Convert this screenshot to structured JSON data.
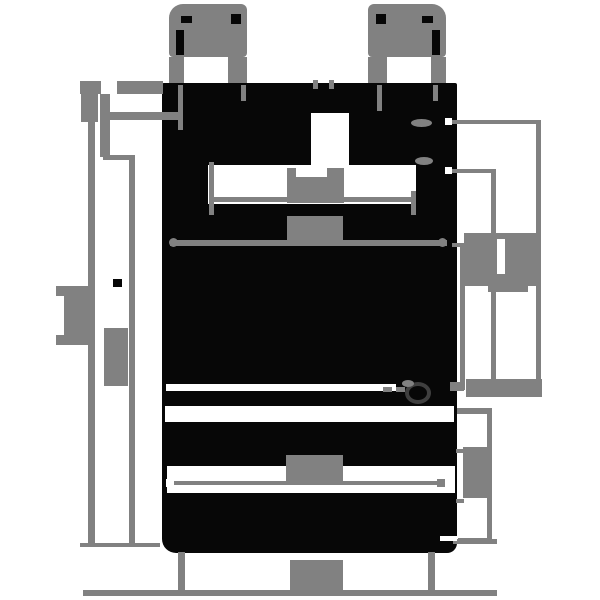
{
  "meta": {
    "kind": "technical-dimension-drawing",
    "canvas": {
      "width": 600,
      "height": 600
    },
    "background": "#ffffff",
    "text_legible": false
  },
  "colors": {
    "ink": "#070707",
    "annotation_gray": "#818181",
    "paper": "#ffffff",
    "hole_ring": "#3f3f3f"
  },
  "drawing": {
    "shapes": [
      {
        "name": "device-body",
        "kind": "ink",
        "x": 162,
        "y": 83,
        "w": 295,
        "h": 470,
        "r": "2px 2px 10px 14px",
        "z": 10
      },
      {
        "name": "cutout-top-center-notch",
        "kind": "paper",
        "x": 311,
        "y": 113,
        "w": 38,
        "h": 55,
        "z": 20
      },
      {
        "name": "cutout-top-recess",
        "kind": "paper",
        "x": 208,
        "y": 165,
        "w": 208,
        "h": 39,
        "z": 20
      },
      {
        "name": "cutout-groove-line",
        "kind": "paper",
        "x": 166,
        "y": 384,
        "w": 230,
        "h": 7,
        "z": 20
      },
      {
        "name": "cutout-step-band",
        "kind": "paper",
        "x": 165,
        "y": 406,
        "w": 289,
        "h": 16,
        "z": 20
      },
      {
        "name": "cutout-lower-band",
        "kind": "paper",
        "x": 167,
        "y": 466,
        "w": 288,
        "h": 27,
        "z": 20
      },
      {
        "name": "mounting-hole-ring",
        "kind": "hole",
        "x": 405,
        "y": 382,
        "w": 26,
        "h": 22,
        "z": 26
      },
      {
        "name": "mounting-hole-glint",
        "kind": "grayround",
        "x": 402,
        "y": 380,
        "w": 12,
        "h": 7,
        "z": 27
      },
      {
        "name": "screw-right-arc-top",
        "kind": "grayround",
        "x": 411,
        "y": 119,
        "w": 21,
        "h": 8,
        "z": 25
      },
      {
        "name": "screw-right-arc-bottom",
        "kind": "grayround",
        "x": 415,
        "y": 157,
        "w": 18,
        "h": 8,
        "z": 25
      },
      {
        "name": "tab-left-body",
        "kind": "gray",
        "x": 169,
        "y": 4,
        "w": 78,
        "h": 53,
        "r": "14px 6px 4px 4px",
        "z": 15
      },
      {
        "name": "tab-left-slot",
        "kind": "ink",
        "x": 176,
        "y": 30,
        "w": 8,
        "h": 25,
        "z": 16
      },
      {
        "name": "tab-left-mark-top",
        "kind": "ink",
        "x": 181,
        "y": 16,
        "w": 11,
        "h": 7,
        "z": 16
      },
      {
        "name": "tab-left-mark-corner",
        "kind": "ink",
        "x": 231,
        "y": 14,
        "w": 10,
        "h": 10,
        "z": 16
      },
      {
        "name": "tab-left-leg-left",
        "kind": "gray",
        "x": 169,
        "y": 57,
        "w": 15,
        "h": 26,
        "z": 15
      },
      {
        "name": "tab-left-leg-right",
        "kind": "gray",
        "x": 228,
        "y": 57,
        "w": 19,
        "h": 26,
        "z": 15
      },
      {
        "name": "tab-right-body",
        "kind": "gray",
        "x": 368,
        "y": 4,
        "w": 78,
        "h": 53,
        "r": "6px 14px 4px 4px",
        "z": 15
      },
      {
        "name": "tab-right-mark-corner",
        "kind": "ink",
        "x": 376,
        "y": 14,
        "w": 10,
        "h": 10,
        "z": 16
      },
      {
        "name": "tab-right-mark-top",
        "kind": "ink",
        "x": 422,
        "y": 16,
        "w": 11,
        "h": 7,
        "z": 16
      },
      {
        "name": "tab-right-slot",
        "kind": "ink",
        "x": 432,
        "y": 30,
        "w": 8,
        "h": 25,
        "z": 16
      },
      {
        "name": "tab-right-leg-left",
        "kind": "gray",
        "x": 368,
        "y": 57,
        "w": 19,
        "h": 26,
        "z": 15
      },
      {
        "name": "tab-right-leg-right",
        "kind": "gray",
        "x": 431,
        "y": 57,
        "w": 15,
        "h": 26,
        "z": 15
      },
      {
        "name": "ext-tick-tab-left-outer",
        "kind": "gray",
        "x": 178,
        "y": 85,
        "w": 5,
        "h": 45,
        "z": 25
      },
      {
        "name": "ext-tick-tab-left-inner",
        "kind": "gray",
        "x": 241,
        "y": 85,
        "w": 5,
        "h": 16,
        "z": 25
      },
      {
        "name": "ext-tick-tab-right-inner",
        "kind": "gray",
        "x": 377,
        "y": 85,
        "w": 5,
        "h": 26,
        "z": 25
      },
      {
        "name": "ext-tick-tab-right-outer",
        "kind": "gray",
        "x": 433,
        "y": 85,
        "w": 5,
        "h": 16,
        "z": 25
      },
      {
        "name": "ext-tick-center-left",
        "kind": "gray",
        "x": 313,
        "y": 80,
        "w": 5,
        "h": 9,
        "z": 25
      },
      {
        "name": "ext-tick-center-right",
        "kind": "gray",
        "x": 329,
        "y": 80,
        "w": 5,
        "h": 9,
        "z": 25
      },
      {
        "name": "dim-topleft-bar-a",
        "kind": "gray",
        "x": 80,
        "y": 81,
        "w": 21,
        "h": 13,
        "z": 30
      },
      {
        "name": "dim-topleft-bar-b",
        "kind": "gray",
        "x": 117,
        "y": 81,
        "w": 46,
        "h": 13,
        "z": 30
      },
      {
        "name": "dim-topleft-vline",
        "kind": "gray",
        "x": 100,
        "y": 94,
        "w": 10,
        "h": 63,
        "z": 30
      },
      {
        "name": "dim-topleft-arm",
        "kind": "gray",
        "x": 100,
        "y": 112,
        "w": 78,
        "h": 8,
        "z": 30
      },
      {
        "name": "dim-topleft-jog",
        "kind": "gray",
        "x": 103,
        "y": 155,
        "w": 32,
        "h": 5,
        "z": 30
      },
      {
        "name": "dim-left-outer-vline",
        "kind": "gray",
        "x": 88,
        "y": 94,
        "w": 7,
        "h": 453,
        "z": 30
      },
      {
        "name": "dim-left-outer-blob",
        "kind": "gray",
        "x": 81,
        "y": 94,
        "w": 17,
        "h": 28,
        "z": 30
      },
      {
        "name": "dim-left-outer-text-serif-top",
        "kind": "gray",
        "x": 56,
        "y": 286,
        "w": 34,
        "h": 10,
        "z": 30
      },
      {
        "name": "dim-left-outer-text-body",
        "kind": "gray",
        "x": 64,
        "y": 296,
        "w": 26,
        "h": 40,
        "z": 30
      },
      {
        "name": "dim-left-outer-text-serif-bottom",
        "kind": "gray",
        "x": 56,
        "y": 335,
        "w": 34,
        "h": 10,
        "z": 30
      },
      {
        "name": "dim-left-text-ink-speck",
        "kind": "ink",
        "x": 113,
        "y": 279,
        "w": 9,
        "h": 8,
        "z": 30
      },
      {
        "name": "dim-left-inner-vline",
        "kind": "gray",
        "x": 129,
        "y": 158,
        "w": 6,
        "h": 389,
        "z": 30
      },
      {
        "name": "dim-left-inner-text",
        "kind": "gray",
        "x": 104,
        "y": 328,
        "w": 24,
        "h": 58,
        "z": 30
      },
      {
        "name": "dim-bottom-ref-left",
        "kind": "gray",
        "x": 80,
        "y": 543,
        "w": 80,
        "h": 4,
        "z": 5
      },
      {
        "name": "dim-bottom-ref-right",
        "kind": "gray",
        "x": 453,
        "y": 539,
        "w": 44,
        "h": 5,
        "z": 30
      },
      {
        "name": "dim-recess-line",
        "kind": "gray",
        "x": 210,
        "y": 197,
        "w": 206,
        "h": 5,
        "z": 30
      },
      {
        "name": "dim-recess-tick-left",
        "kind": "gray",
        "x": 209,
        "y": 162,
        "w": 5,
        "h": 53,
        "z": 30
      },
      {
        "name": "dim-recess-tick-right",
        "kind": "gray",
        "x": 411,
        "y": 191,
        "w": 5,
        "h": 24,
        "z": 30
      },
      {
        "name": "dim-recess-text-prong-a",
        "kind": "gray",
        "x": 287,
        "y": 168,
        "w": 9,
        "h": 10,
        "z": 30
      },
      {
        "name": "dim-recess-text-prong-b",
        "kind": "gray",
        "x": 327,
        "y": 168,
        "w": 17,
        "h": 10,
        "z": 30
      },
      {
        "name": "dim-recess-text-body",
        "kind": "gray",
        "x": 287,
        "y": 177,
        "w": 57,
        "h": 26,
        "z": 30
      },
      {
        "name": "dim-innerwidth-text",
        "kind": "gray",
        "x": 287,
        "y": 216,
        "w": 56,
        "h": 26,
        "z": 30
      },
      {
        "name": "dim-innerwidth-line",
        "kind": "gray",
        "x": 170,
        "y": 240,
        "w": 277,
        "h": 6,
        "z": 30
      },
      {
        "name": "dim-innerwidth-cap-left",
        "kind": "grayround",
        "x": 169,
        "y": 238,
        "w": 9,
        "h": 9,
        "z": 30
      },
      {
        "name": "dim-innerwidth-cap-right",
        "kind": "grayround",
        "x": 438,
        "y": 238,
        "w": 9,
        "h": 9,
        "z": 30
      },
      {
        "name": "dim-right-ext-top",
        "kind": "gray",
        "x": 450,
        "y": 120,
        "w": 90,
        "h": 4,
        "z": 30
      },
      {
        "name": "dim-right-ext-top-arrow",
        "kind": "paper",
        "x": 445,
        "y": 118,
        "w": 7,
        "h": 7,
        "z": 35
      },
      {
        "name": "dim-right-vline-outer",
        "kind": "gray",
        "x": 536,
        "y": 120,
        "w": 5,
        "h": 270,
        "z": 30
      },
      {
        "name": "dim-right-ext-mid",
        "kind": "gray",
        "x": 450,
        "y": 169,
        "w": 45,
        "h": 4,
        "z": 30
      },
      {
        "name": "dim-right-ext-mid-arrow",
        "kind": "paper",
        "x": 445,
        "y": 167,
        "w": 7,
        "h": 7,
        "z": 35
      },
      {
        "name": "dim-right-vline-mid",
        "kind": "gray",
        "x": 491,
        "y": 169,
        "w": 5,
        "h": 221,
        "z": 30
      },
      {
        "name": "dim-right-bracket-arm-top",
        "kind": "gray",
        "x": 452,
        "y": 243,
        "w": 10,
        "h": 4,
        "z": 30
      },
      {
        "name": "dim-right-bracket-vline",
        "kind": "gray",
        "x": 460,
        "y": 243,
        "w": 5,
        "h": 147,
        "z": 30
      },
      {
        "name": "dim-right-text-block",
        "kind": "gray",
        "x": 464,
        "y": 233,
        "w": 73,
        "h": 53,
        "z": 30
      },
      {
        "name": "dim-right-text-slot",
        "kind": "paper",
        "x": 497,
        "y": 239,
        "w": 8,
        "h": 35,
        "z": 35
      },
      {
        "name": "dim-right-text-tail",
        "kind": "gray",
        "x": 488,
        "y": 284,
        "w": 40,
        "h": 8,
        "z": 30
      },
      {
        "name": "dim-hole-arrow-band",
        "kind": "gray",
        "x": 466,
        "y": 379,
        "w": 76,
        "h": 18,
        "z": 30
      },
      {
        "name": "dim-hole-band-wall-tick",
        "kind": "gray",
        "x": 450,
        "y": 382,
        "w": 14,
        "h": 9,
        "z": 30
      },
      {
        "name": "dim-hole-centerline-a",
        "kind": "gray",
        "x": 383,
        "y": 387,
        "w": 9,
        "h": 5,
        "z": 30
      },
      {
        "name": "dim-hole-centerline-b",
        "kind": "gray",
        "x": 396,
        "y": 387,
        "w": 9,
        "h": 5,
        "z": 30
      },
      {
        "name": "dim-lowerright-arm-top",
        "kind": "gray",
        "x": 457,
        "y": 408,
        "w": 33,
        "h": 6,
        "z": 30
      },
      {
        "name": "dim-lowerright-vline",
        "kind": "gray",
        "x": 487,
        "y": 408,
        "w": 5,
        "h": 135,
        "z": 30
      },
      {
        "name": "dim-lowerright-arm-bottom",
        "kind": "gray",
        "x": 458,
        "y": 538,
        "w": 33,
        "h": 5,
        "z": 30
      },
      {
        "name": "dim-lowerright-arm-bottom-white",
        "kind": "paper",
        "x": 440,
        "y": 536,
        "w": 17,
        "h": 5,
        "z": 35
      },
      {
        "name": "dim-lowerright-inner-text",
        "kind": "gray",
        "x": 463,
        "y": 447,
        "w": 25,
        "h": 51,
        "z": 30
      },
      {
        "name": "dim-lowerright-inner-tick-top",
        "kind": "gray",
        "x": 456,
        "y": 449,
        "w": 8,
        "h": 4,
        "z": 30
      },
      {
        "name": "dim-lowerright-inner-tick-bottom",
        "kind": "gray",
        "x": 456,
        "y": 499,
        "w": 8,
        "h": 4,
        "z": 30
      },
      {
        "name": "dim-lowerwidth-text",
        "kind": "gray",
        "x": 286,
        "y": 455,
        "w": 57,
        "h": 28,
        "z": 30
      },
      {
        "name": "dim-lowerwidth-line",
        "kind": "gray",
        "x": 172,
        "y": 481,
        "w": 271,
        "h": 4,
        "z": 30
      },
      {
        "name": "dim-lowerwidth-arrow-left",
        "kind": "paper",
        "x": 166,
        "y": 479,
        "w": 8,
        "h": 8,
        "z": 35
      },
      {
        "name": "dim-lowerwidth-arrow-right",
        "kind": "gray",
        "x": 437,
        "y": 479,
        "w": 8,
        "h": 8,
        "z": 30
      },
      {
        "name": "dim-bottom-ext-left",
        "kind": "gray",
        "x": 178,
        "y": 552,
        "w": 7,
        "h": 40,
        "z": 30
      },
      {
        "name": "dim-bottom-ext-right",
        "kind": "gray",
        "x": 428,
        "y": 552,
        "w": 7,
        "h": 40,
        "z": 30
      },
      {
        "name": "dim-bottom-line",
        "kind": "gray",
        "x": 83,
        "y": 590,
        "w": 414,
        "h": 6,
        "z": 30
      },
      {
        "name": "dim-bottom-text",
        "kind": "gray",
        "x": 290,
        "y": 560,
        "w": 53,
        "h": 32,
        "z": 30
      }
    ]
  }
}
